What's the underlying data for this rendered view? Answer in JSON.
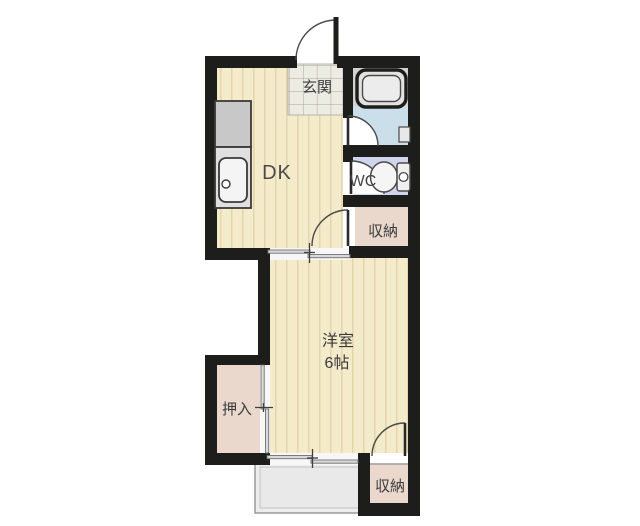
{
  "floorplan": {
    "labels": {
      "entrance": "玄関",
      "dining_kitchen": "DK",
      "toilet": "WC",
      "storage_mid": "収納",
      "western_room": "洋室",
      "western_room_size": "6帖",
      "closet": "押入",
      "storage_bottom": "収納"
    },
    "colors": {
      "wall": "#1d1d1b",
      "wood_floor": "#f4ebca",
      "wood_stripe": "#e2d4a9",
      "entrance_tile": "#edece3",
      "tile_line": "#a9a79d",
      "tub_area": "#d2d2d2",
      "bath_floor": "#cbdfeb",
      "wc_floor": "#ced5ec",
      "closet_fill": "#ead8cd",
      "balcony_fill": "#ededed"
    }
  }
}
